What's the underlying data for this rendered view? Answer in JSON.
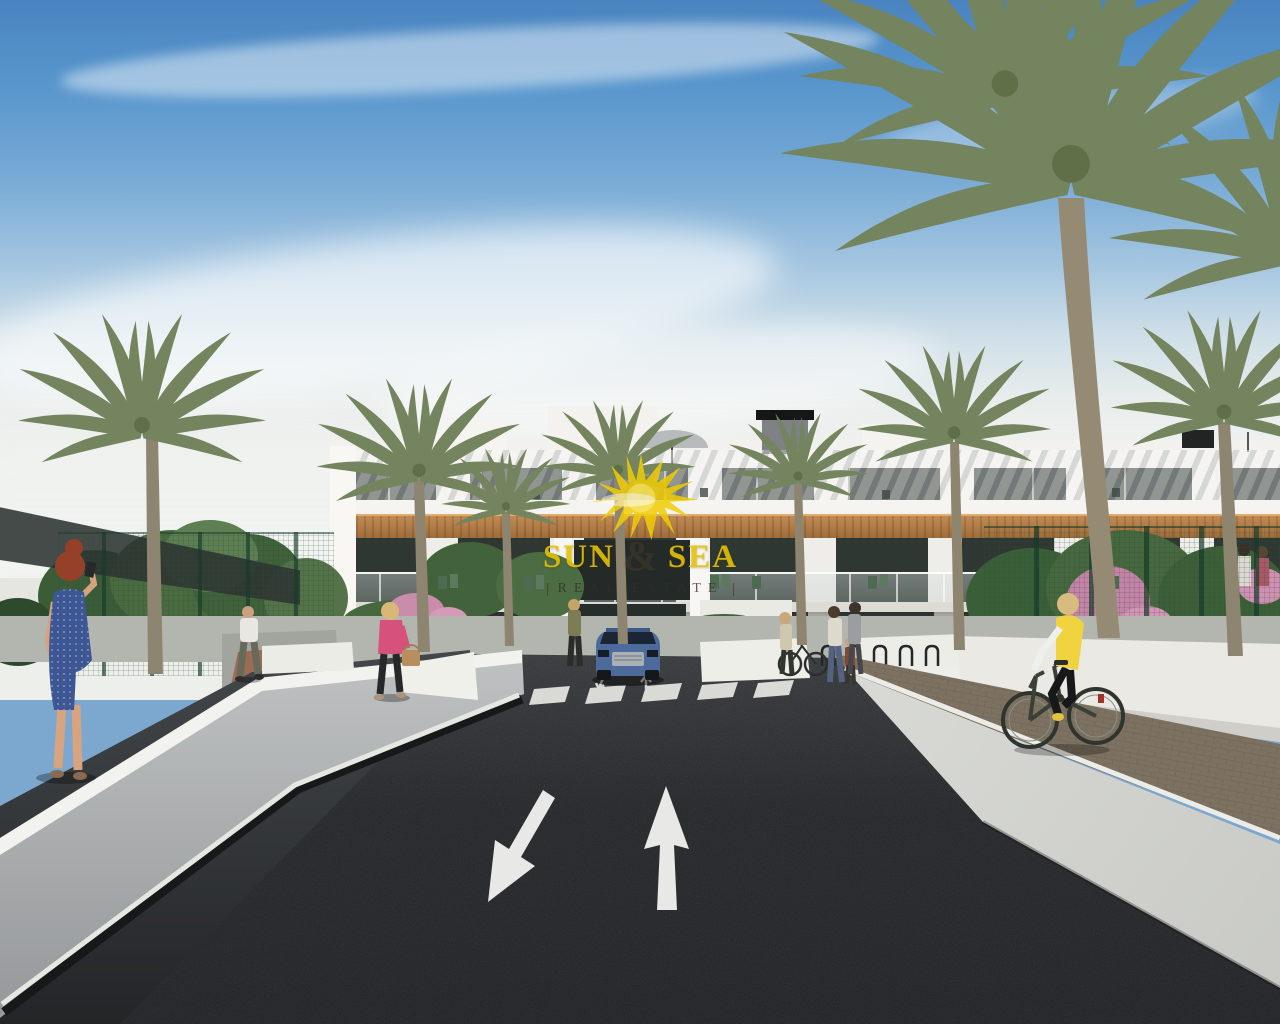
{
  "watermark": {
    "word1": "SUN",
    "amp": "&",
    "word2": "SEA",
    "subtitle": "REAL ESTATE",
    "title_color": "#e5c104",
    "subtitle_color": "#332e28",
    "sun_color": "#f0cc04"
  },
  "scene": {
    "setting": "architectural render of a modern white apartment complex with palm trees and entry road",
    "sky": {
      "top": "#4a84c0",
      "horizon": "#e9edec",
      "clouds": "wispy white streaks"
    },
    "building": {
      "wall": "#f2f1ed",
      "wood_cladding": "#a9763f",
      "glazing": "#2c342f",
      "floors": 3
    },
    "road": {
      "surface": "#232527",
      "markings": [
        "down-left arrow",
        "up arrow",
        "zebra crossing"
      ],
      "crosswalk_stripes": 6
    },
    "paths": {
      "sidewalk": "#d5d6d2",
      "brick_path": "#7d7161",
      "white_walls": "#ebece6"
    },
    "vehicles": [
      {
        "type": "suv",
        "color": "#4c6a9b"
      }
    ],
    "people": [
      "woman photographing in blue dress",
      "man walking on path",
      "woman in pink jacket with handbag",
      "woman beside car",
      "adults with child and bicycle",
      "cyclist in yellow vest",
      "couple on balcony"
    ],
    "vegetation": {
      "palms": 9,
      "flower_color": "#c985a8",
      "fence_color": "#2f5e45"
    }
  }
}
